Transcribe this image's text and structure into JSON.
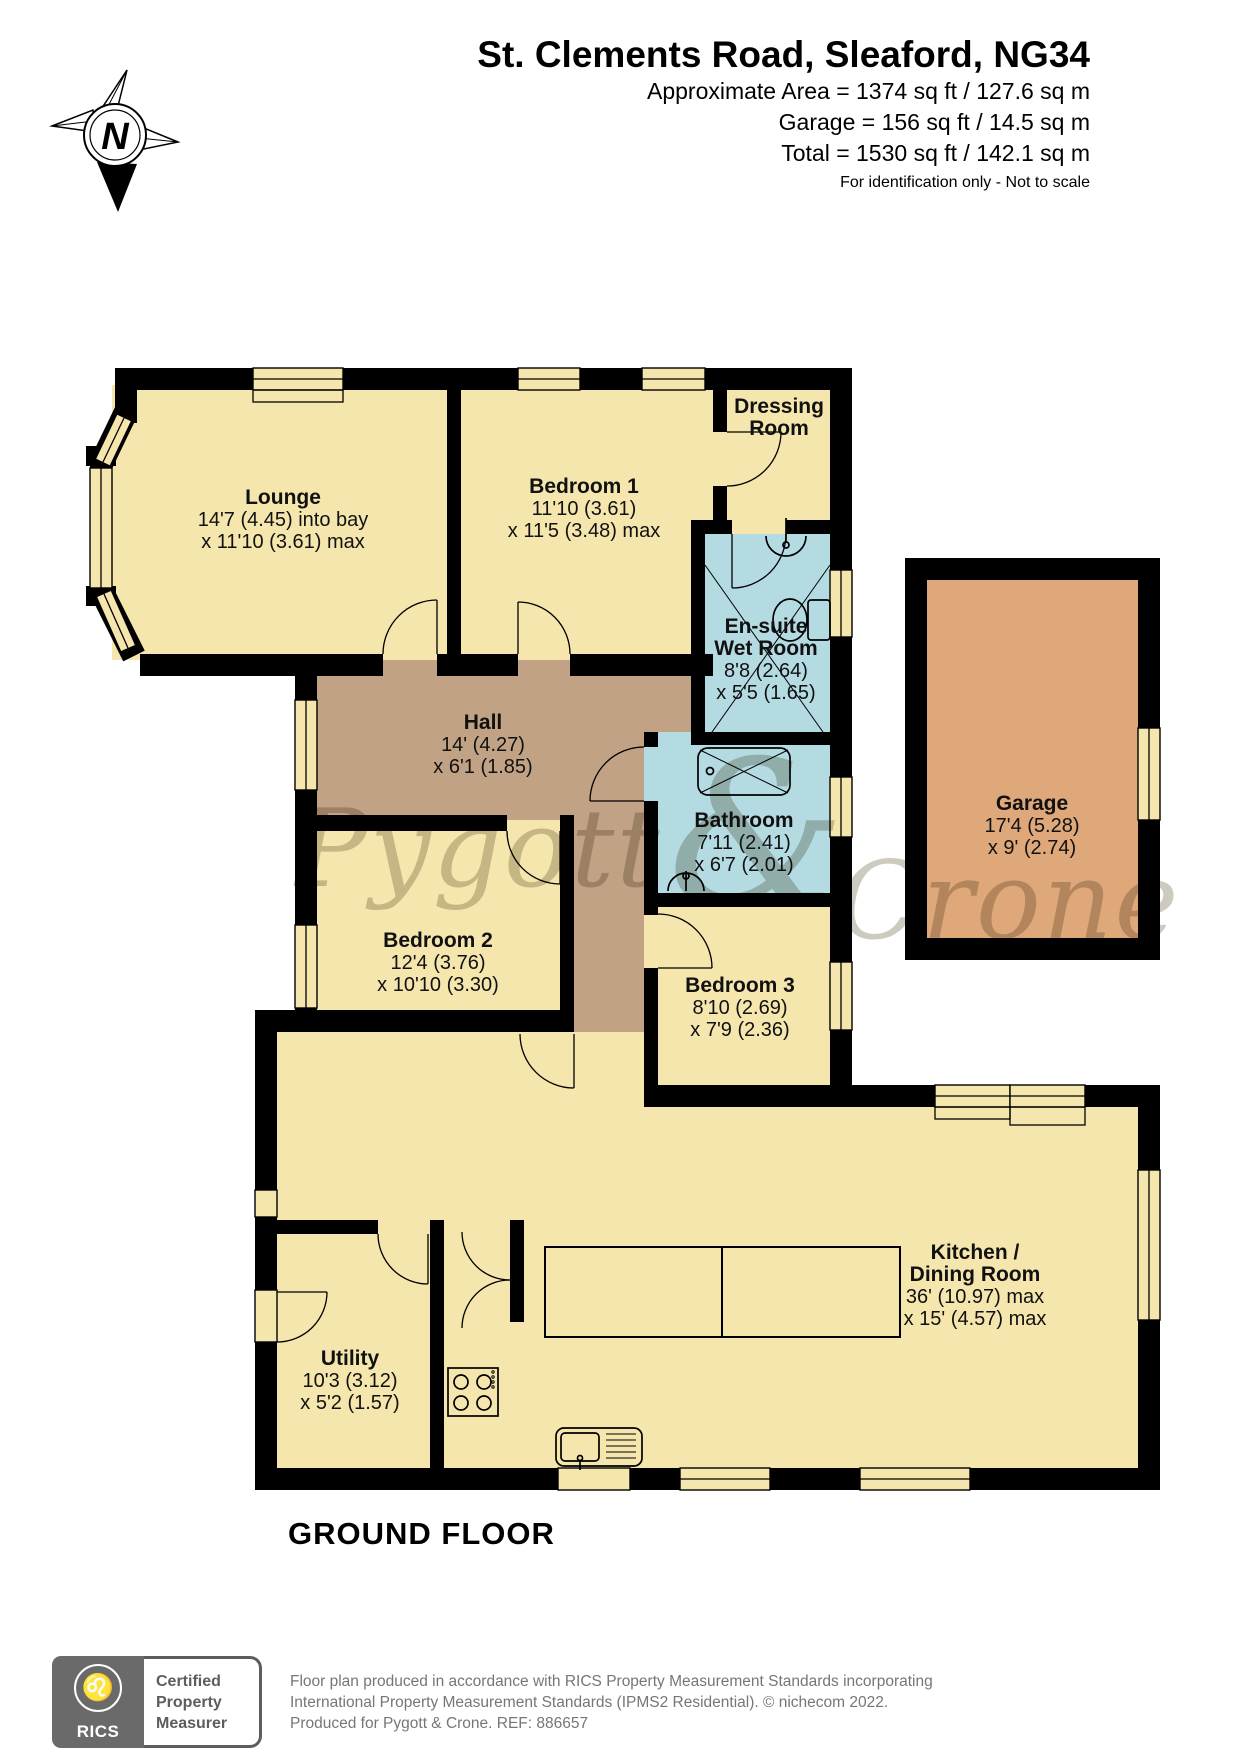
{
  "header": {
    "title": "St. Clements Road, Sleaford, NG34",
    "area_lines": [
      "Approximate Area = 1374 sq ft / 127.6 sq m",
      "Garage = 156 sq ft / 14.5 sq m",
      "Total = 1530 sq ft / 142.1 sq m"
    ],
    "note": "For identification only - Not to scale"
  },
  "compass": {
    "label": "N"
  },
  "watermark": {
    "word1": "Pygott",
    "amp": "&",
    "word2": "Crone"
  },
  "rooms": {
    "lounge": {
      "name": "Lounge",
      "dim1": "14'7 (4.45) into bay",
      "dim2": "x 11'10 (3.61) max"
    },
    "bedroom1": {
      "name": "Bedroom 1",
      "dim1": "11'10 (3.61)",
      "dim2": "x 11'5 (3.48) max"
    },
    "dressing": {
      "name": "Dressing",
      "name2": "Room"
    },
    "ensuite": {
      "name": "En-suite",
      "name2": "Wet Room",
      "dim1": "8'8 (2.64)",
      "dim2": "x 5'5 (1.65)"
    },
    "bathroom": {
      "name": "Bathroom",
      "dim1": "7'11 (2.41)",
      "dim2": "x 6'7 (2.01)"
    },
    "hall": {
      "name": "Hall",
      "dim1": "14' (4.27)",
      "dim2": "x 6'1 (1.85)"
    },
    "bedroom2": {
      "name": "Bedroom 2",
      "dim1": "12'4 (3.76)",
      "dim2": "x 10'10 (3.30)"
    },
    "bedroom3": {
      "name": "Bedroom 3",
      "dim1": "8'10 (2.69)",
      "dim2": "x 7'9 (2.36)"
    },
    "garage": {
      "name": "Garage",
      "dim1": "17'4 (5.28)",
      "dim2": "x 9' (2.74)"
    },
    "kitchen": {
      "name": "Kitchen /",
      "name2": "Dining Room",
      "dim1": "36' (10.97) max",
      "dim2": "x 15' (4.57) max"
    },
    "utility": {
      "name": "Utility",
      "dim1": "10'3 (3.12)",
      "dim2": "x 5'2 (1.57)"
    }
  },
  "floor_label": "GROUND FLOOR",
  "footer": {
    "rics_label": "RICS",
    "badge_lines": [
      "Certified",
      "Property",
      "Measurer"
    ],
    "lines": [
      "Floor plan produced in accordance with RICS Property Measurement Standards incorporating",
      "International Property Measurement Standards (IPMS2 Residential).   © nichecom 2022.",
      "Produced for Pygott & Crone.   REF: 886657"
    ]
  },
  "colors": {
    "room": "#F5E6AE",
    "wet": "#B5DBE2",
    "hall": "#C2A284",
    "garage": "#DFA87A",
    "wall": "#000000",
    "watermark": "#A39E8C"
  }
}
